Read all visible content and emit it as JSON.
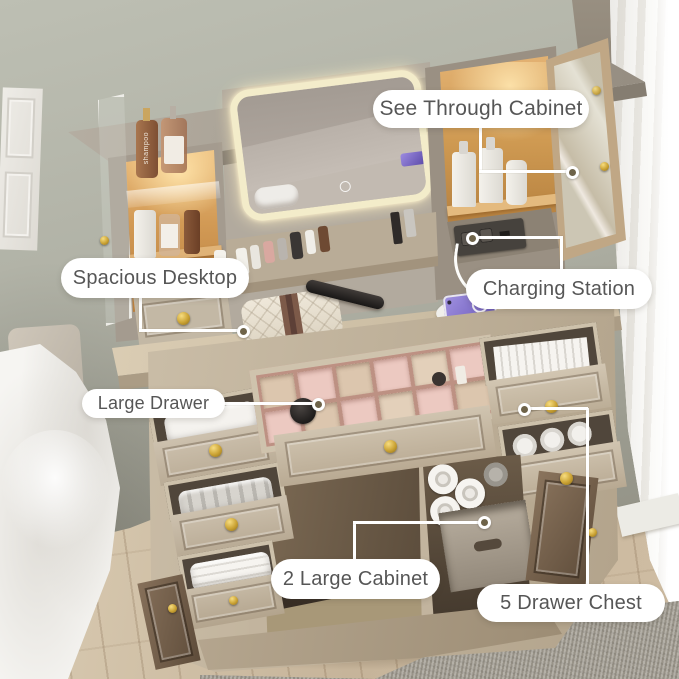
{
  "image_type": "annotated product lifestyle photo",
  "subject": "makeup vanity desk with LED mirror, lighted cabinets and storage drawers in a bedroom",
  "annotations": {
    "see_through_cabinet": "See Through Cabinet",
    "spacious_desktop": "Spacious Desktop",
    "charging_station": "Charging Station",
    "large_drawer": "Large Drawer",
    "two_large_cabinet": "2 Large Cabinet",
    "five_drawer_chest": "5 Drawer Chest"
  },
  "bottle_text": "shampoo",
  "colors": {
    "callout_bg": "#ffffff",
    "callout_text": "#565656",
    "connector_line": "#ffffff",
    "connector_dot_fill": "#6e6349",
    "led_glow": "#f3ecca",
    "gold_hardware": "#caa233",
    "wood_light": "#cfc2ab",
    "wood_warm_interior": "#c68f52",
    "wall": "#a9aa9e",
    "floor": "#cdbca3",
    "rug": "#a19c91",
    "organizer_pink": "#e8c4bc",
    "phone_purple": "#8d7bd8"
  }
}
